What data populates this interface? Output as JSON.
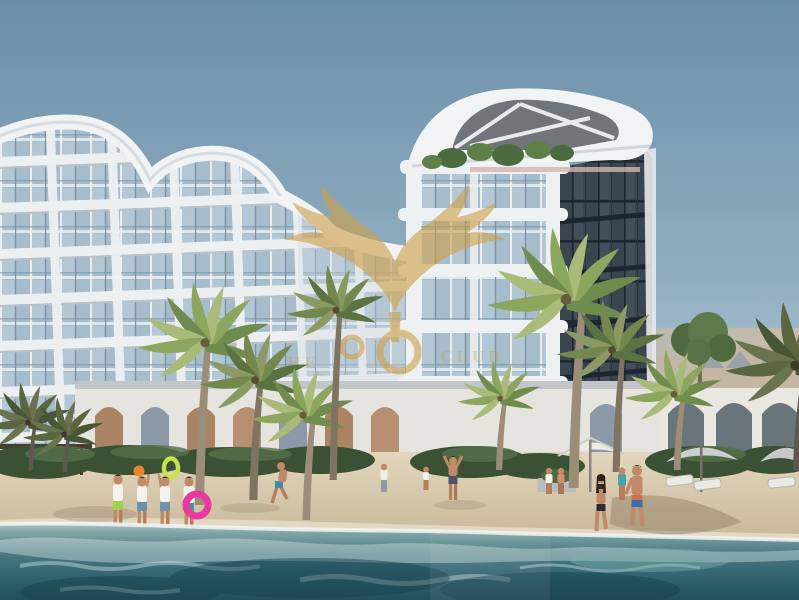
{
  "meta": {
    "kind": "architectural-rendering",
    "subject": "Beachfront residential resort: curved white apartment block, glass tower with sculpted rooftop, palm-lined sand beach and turquoise sea with swimmers",
    "width_px": 799,
    "height_px": 600
  },
  "watermark": {
    "text_left": "THE",
    "text_right": "CLUB",
    "symbol": "gold-eagle-wings-emblem",
    "gold": "#c99c42"
  },
  "palette": {
    "sky_top": "#6a8fa8",
    "sky_horizon": "#d2dce2",
    "building_white": "#eff1f2",
    "glass_light": "#a6bccb",
    "glass_dark": "#39454f",
    "glass_warm": "#a58a74",
    "palm_green": "#7d9757",
    "hedge_green": "#3a5233",
    "sand": "#d8cbae",
    "water_deep": "#23505c",
    "foam_white": "#eef4f2",
    "ring_pink": "#ea3aa2",
    "ring_lime": "#c6e24b",
    "ball_orange": "#e8872a"
  },
  "scene": {
    "left_building": "curved white residential block with glass grid facade",
    "tower": "glass tower with white curved canopy roof and roof garden",
    "clubhouse": "white arched beach clubhouse row",
    "beach": "sand beach with palms, white and grey umbrellas, loungers",
    "water": "turquoise sea with foam in foreground",
    "people_count": 13,
    "palm_count": 10,
    "umbrella_count": 3,
    "lounger_count": 3
  }
}
